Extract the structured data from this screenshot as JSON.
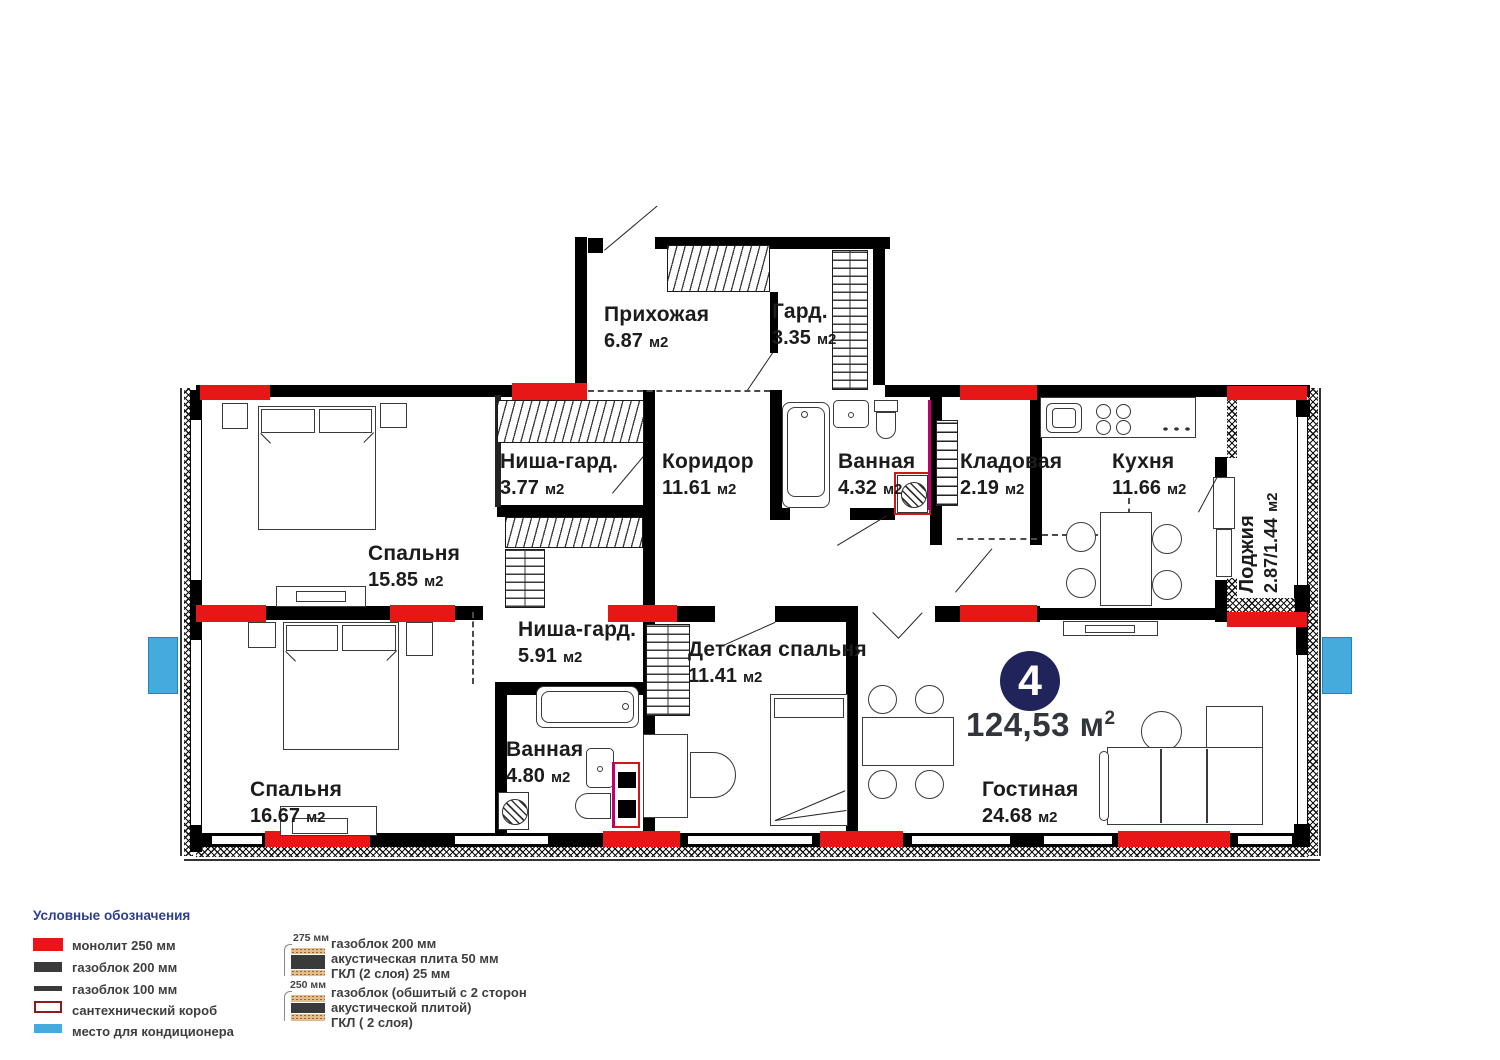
{
  "plan": {
    "badge": {
      "number": "4",
      "area": "124,53",
      "unit": "м",
      "sup": "2"
    },
    "rooms": [
      {
        "id": "prihozhaya",
        "name": "Прихожая",
        "area": "6.87",
        "unit": "м2"
      },
      {
        "id": "gard",
        "name": "Гард.",
        "area": "3.35",
        "unit": "м2"
      },
      {
        "id": "nisha_377",
        "name": "Ниша-гард.",
        "area": "3.77",
        "unit": "м2"
      },
      {
        "id": "koridor",
        "name": "Коридор",
        "area": "11.61",
        "unit": "м2"
      },
      {
        "id": "vannaya_432",
        "name": "Ванная",
        "area": "4.32",
        "unit": "м2"
      },
      {
        "id": "kladovaya",
        "name": "Кладовая",
        "area": "2.19",
        "unit": "м2"
      },
      {
        "id": "kuhnya",
        "name": "Кухня",
        "area": "11.66",
        "unit": "м2"
      },
      {
        "id": "lodzhiya",
        "name": "Лоджия",
        "area": "2.87/1.44",
        "unit": "м2"
      },
      {
        "id": "spalnya_1585",
        "name": "Спальня",
        "area": "15.85",
        "unit": "м2"
      },
      {
        "id": "nisha_591",
        "name": "Ниша-гард.",
        "area": "5.91",
        "unit": "м2"
      },
      {
        "id": "detskaya",
        "name": "Детская спальня",
        "area": "11.41",
        "unit": "м2"
      },
      {
        "id": "spalnya_1667",
        "name": "Спальня",
        "area": "16.67",
        "unit": "м2"
      },
      {
        "id": "vannaya_480",
        "name": "Ванная",
        "area": "4.80",
        "unit": "м2"
      },
      {
        "id": "gostinaya",
        "name": "Гостиная",
        "area": "24.68",
        "unit": "м2"
      }
    ]
  },
  "legend": {
    "title": "Условные обозначения",
    "items": [
      {
        "label": "монолит 250 мм"
      },
      {
        "label": "газоблок 200 мм"
      },
      {
        "label": "газоблок 100 мм"
      },
      {
        "label": "сантехнический короб"
      },
      {
        "label": "место для кондиционера"
      }
    ],
    "wall_types": [
      {
        "size": "275 мм",
        "lines": [
          "газоблок 200 мм",
          "акустическая плита 50 мм",
          "ГКЛ (2 слоя) 25 мм"
        ]
      },
      {
        "size": "250 мм",
        "lines": [
          "газоблок (обшитый с 2 сторон",
          "акустической плитой)",
          "ГКЛ ( 2 слоя)"
        ]
      }
    ]
  },
  "colors": {
    "monolith_red": "#e81717",
    "ac_blue": "#45abdd",
    "badge_navy": "#20245a"
  }
}
